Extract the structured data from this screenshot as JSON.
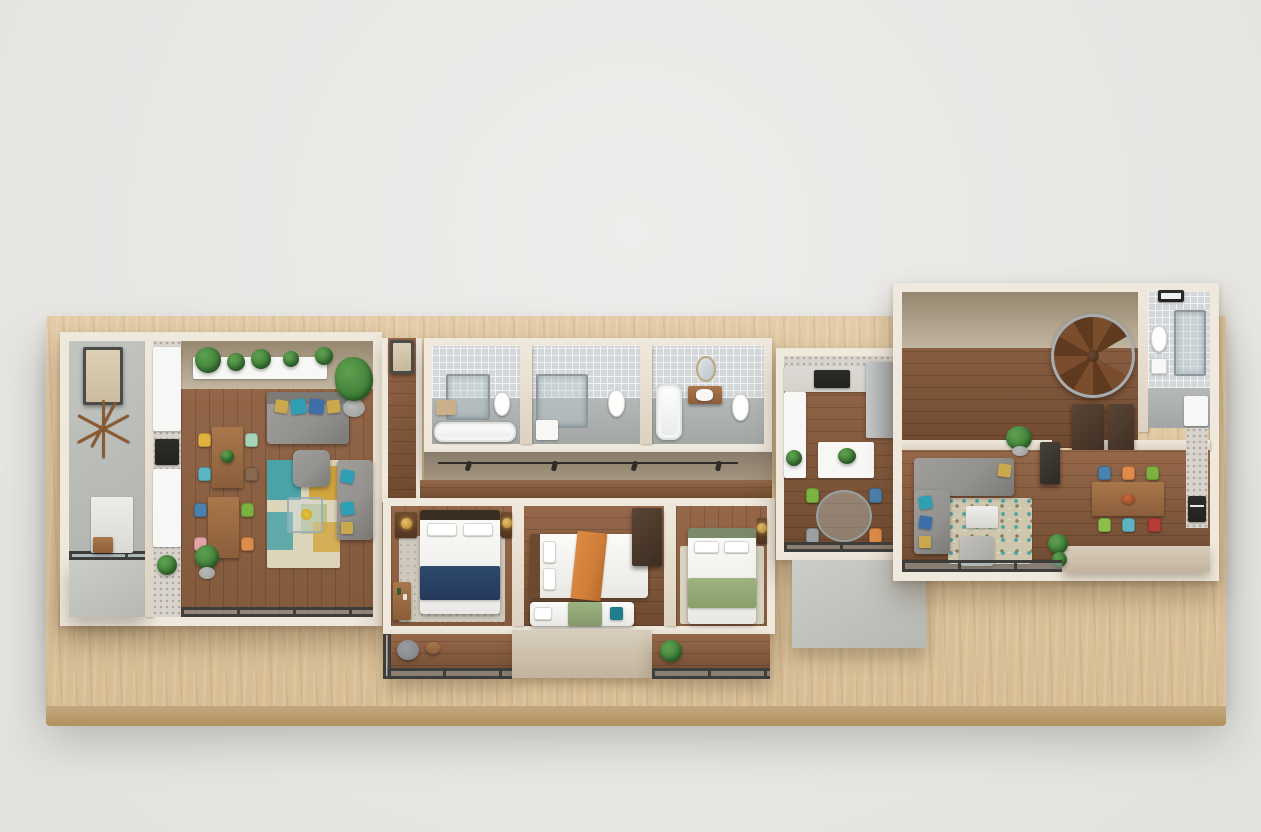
{
  "scene": {
    "description": "Photoreal isometric dollhouse render of a single-storey apartment floor-plan model sitting on a light wooden presentation base against a plain light-gray studio background.",
    "style": "3D architectural cutaway, top-down three-quarter view, walls cut flat and capped in white",
    "background_color": "#e9e8e6",
    "base": {
      "label": "Wooden presentation base",
      "top_color": "#dfc7a0",
      "front_color": "#bda177"
    }
  },
  "palette": {
    "bg": "#e9e8e6",
    "base_wood": "#dfc7a0",
    "base_wood_dark": "#c9ad82",
    "base_front": "#bda177",
    "wall_cut": "#efe8dc",
    "wall_face": "#95876f",
    "wall_face_light": "#c3b6a1",
    "wood_floor": "#835a3d",
    "wood_floor_dark": "#6f4a30",
    "wood_floor_light": "#96684a",
    "concrete": "#b9bbb7",
    "concrete_light": "#c8cac6",
    "tile": "#d4d7d9",
    "bath_floor": "#a9aeac",
    "white": "#f7f7f5",
    "steel": "#8f979c",
    "frame_dark": "#3d3d3b",
    "sofa": "#94928f",
    "sofa_dark": "#7c7a77",
    "cushion_gold": "#c9a84e",
    "cushion_teal": "#2e9fb5",
    "cushion_blue": "#3f6fa8",
    "navy": "#2e4a6d",
    "orange_throw": "#cf7f3a",
    "sage": "#9db380",
    "teal_pillow": "#1f7d8c",
    "rug_teal": "#4aa3a6",
    "rug_mustard": "#d2a53e",
    "rug_cream": "#ddd5ba",
    "rug_sage": "#b9c08e",
    "rug_bed": "#cfc9bd",
    "table_wood": "#8b5e3b",
    "table_wood_light": "#a9774b",
    "chair_yellow": "#dfb23d",
    "chair_teal": "#5fb4c4",
    "chair_mint": "#a8d3b8",
    "chair_pink": "#e2a3a6",
    "chair_orange": "#df8c4a",
    "chair_blue": "#4b81ad",
    "chair_green": "#7cb23f",
    "chair_lime": "#8bbf4a",
    "chair_red": "#b93d37",
    "chair_gray": "#9aa0a2",
    "plant": "#3e7d38",
    "plant_light": "#5ea04f",
    "pot": "#9b9d9a",
    "lamp_gold": "#c29440",
    "stair_wood": "#7a4e2c",
    "stair_wood_dark": "#5f3a1f",
    "cabinet": "#d5d2cc",
    "black": "#23231f",
    "fridge": "#b9bcbe",
    "dark_furniture": "#4a3a2b"
  },
  "rooms": [
    {
      "id": "entry-hall",
      "label": "Entry hall with concrete floor",
      "items": [
        "front door",
        "wooden stick coat rack",
        "bench with cushion",
        "small wood tray table"
      ]
    },
    {
      "id": "galley-kitchen",
      "label": "Galley kitchen along entry wall",
      "items": [
        "white upper counter",
        "black cooktop",
        "white lower counter",
        "potted plant"
      ]
    },
    {
      "id": "living-dining",
      "label": "Living and dining room",
      "items": [
        "wall shelves with potted plants",
        "gray sofa with gold and teal sequin pillows",
        "fiddle-leaf plant in gray pot",
        "walnut dining table with yellow, teal, mint and walnut chairs",
        "second dining table with blue, green, pink and orange chairs",
        "patchwork rug in teal, mustard, cream and sage",
        "gray armchair",
        "gray loveseat with teal pillows",
        "glass coffee table with yellow flowers",
        "floor plant"
      ]
    },
    {
      "id": "bathroom-1",
      "label": "Bathroom one",
      "items": [
        "walk-in glass shower",
        "toilet",
        "white bathtub",
        "towel basket"
      ]
    },
    {
      "id": "bathroom-2",
      "label": "Bathroom two",
      "items": [
        "walk-in glass shower",
        "white shower tray",
        "toilet"
      ]
    },
    {
      "id": "bathroom-3",
      "label": "Bathroom three",
      "items": [
        "white bathtub",
        "wood vanity with basin",
        "oval mirror",
        "toilet"
      ]
    },
    {
      "id": "hallway",
      "label": "Hallway with coat rail",
      "items": [
        "corridor door",
        "coat rail with four hooks"
      ]
    },
    {
      "id": "bedroom-1",
      "label": "Bedroom with navy bed",
      "items": [
        "double bed with white duvet and navy throw",
        "dark headboard",
        "two nightstands with brass globe lamps",
        "dotted area rug",
        "writing desk with bottles",
        "balcony with gray stool and side table"
      ]
    },
    {
      "id": "bedroom-2",
      "label": "Bedroom with orange and sage beds",
      "items": [
        "double bed with wood headboard and orange throw",
        "single bed with sage throw and teal cushion",
        "dark wardrobe"
      ]
    },
    {
      "id": "bedroom-3",
      "label": "Bedroom with sage bed",
      "items": [
        "double bed with green headboard and sage throw",
        "nightstand with brass globe lamp",
        "cream rug",
        "balcony with plant"
      ]
    },
    {
      "id": "open-kitchen",
      "label": "Open kitchen with island",
      "items": [
        "gray cabinet run",
        "black cooktop",
        "refrigerator",
        "island with plant",
        "round glass dining table",
        "green, blue, gray and orange chairs",
        "glass wall",
        "concrete patio"
      ]
    },
    {
      "id": "family-room",
      "label": "Family room",
      "items": [
        "L-shaped gray sectional with gold and teal pillows",
        "mosaic pebble rug",
        "coffee table",
        "ottoman",
        "dark media cabinet",
        "potted plants"
      ]
    },
    {
      "id": "dining-room",
      "label": "Dining room",
      "items": [
        "walnut dining table",
        "blue, orange, green, lime, teal and red chairs",
        "fruit bowl"
      ]
    },
    {
      "id": "kitchenette",
      "label": "Kitchenette along right wall",
      "items": [
        "tall white cabinet",
        "speckled counter",
        "black oven"
      ]
    },
    {
      "id": "stair-room",
      "label": "Stair hall",
      "items": [
        "spiral staircase with wood treads and steel railing",
        "two dark door panels",
        "potted plant"
      ]
    },
    {
      "id": "bathroom-4",
      "label": "Bathroom four",
      "items": [
        "toilet",
        "washbasin",
        "glass shower",
        "window"
      ]
    },
    {
      "id": "balconies",
      "label": "Balconies with glass railings",
      "items": [
        "glass railings with dark frames",
        "balcony plants",
        "blank terrace wall"
      ]
    },
    {
      "id": "base",
      "label": "Wooden presentation base"
    }
  ]
}
